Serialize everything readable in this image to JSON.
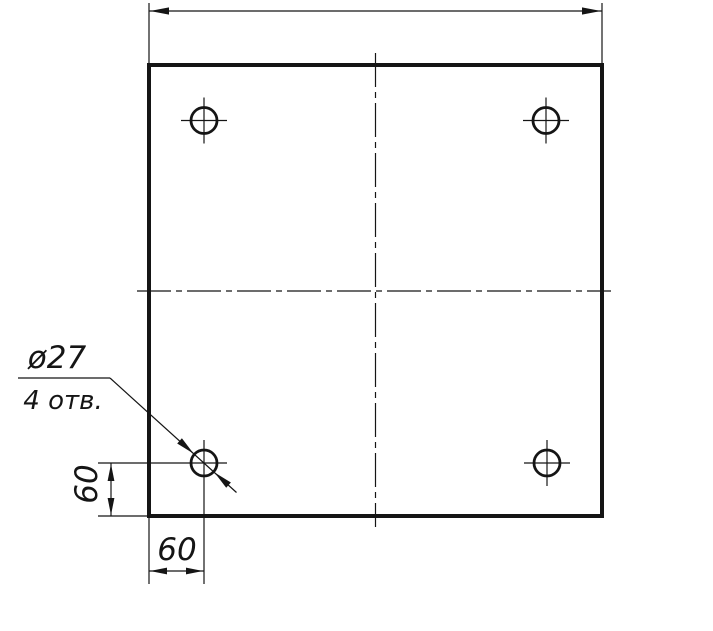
{
  "drawing": {
    "type": "engineering-drawing",
    "view": "square plate top view with four drilled holes",
    "labels": {
      "leader_diameter": "ø27",
      "leader_count": "4 отв.",
      "dim_bottom": "60",
      "dim_left": "60"
    },
    "holes": {
      "count": 4,
      "diameter": 27,
      "offset_from_left_edge": 60,
      "offset_from_bottom_edge": 60
    },
    "colors": {
      "line": "#151515",
      "background": "#ffffff"
    }
  }
}
